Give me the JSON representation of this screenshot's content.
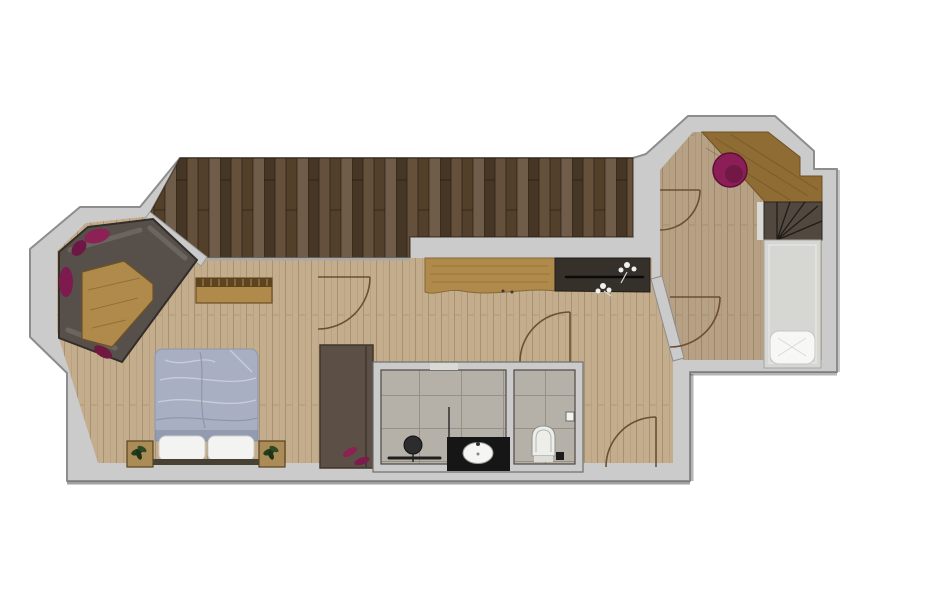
{
  "title": "suite-floor-plan",
  "palette": {
    "background": "#ffffff",
    "wall": "#cbcbcb",
    "wall_edge": "#8d8d8d",
    "wall_line": "#6e6e6e",
    "terrace": "#5a452f",
    "terrace_edge": "#33261731",
    "floor_main": "#c4ad8c",
    "floor_wing": "#b7a184",
    "bath_tile": "#b6b1a8",
    "sofa_platform": "#57504a",
    "cushion_magenta": "#8c2156",
    "oak": "#b08a4a",
    "oak_dark": "#8f6c33",
    "bench_top": "#5d431f",
    "counter_dark": "#36302a",
    "bed_duvet": "#a8afc2",
    "bed_fold_light": "#c9cdda",
    "bed_fold_dark": "#8d94a9",
    "pillow": "#f3f3f1",
    "headboard": "#474035",
    "nightstand": "#ab8c57",
    "plant": "#223c1e",
    "wardrobe": "#5c5046",
    "vanity": "#161616",
    "sink": "#f5f5f3",
    "toilet": "#ededea",
    "stairs": "#514940",
    "stair_landing": "#d9d9d6",
    "single_bed": "#d6d6d3",
    "single_pillow": "#f7f7f5",
    "armchair": "#8c1e57",
    "door_arc": "#6b4f33",
    "flower_white": "#f0f0ee"
  },
  "rooms": {
    "terrace": "terrace-deck",
    "lounge": "bay-window-lounge",
    "bedroom": "main-bedroom",
    "bathroom": "bathroom",
    "wc": "toilet-room",
    "corridor": "entry-corridor",
    "wing": "stair-room"
  },
  "furniture": [
    "corner-sofa-platform",
    "coffee-table",
    "window-cushions",
    "bench-sideboard",
    "double-bed",
    "bed-pillows",
    "nightstand-left",
    "nightstand-right",
    "wardrobe",
    "live-edge-counter",
    "dark-counter-with-flowers",
    "vanity-with-sink",
    "round-mirror",
    "towel-rail",
    "toilet",
    "winder-staircase",
    "sloped-oak-panel",
    "magenta-armchair",
    "single-bed"
  ]
}
